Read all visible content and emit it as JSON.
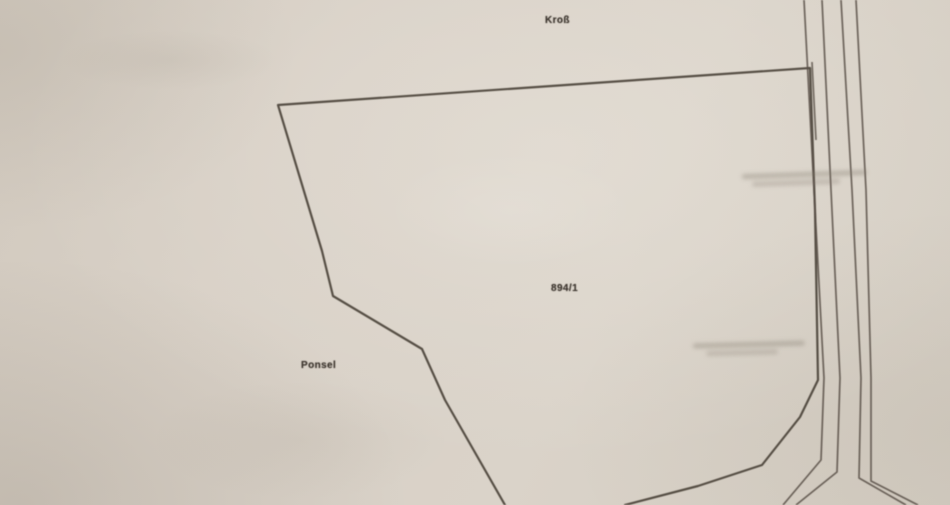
{
  "labels": {
    "top": "Kroß",
    "parcel_number": "894/1",
    "left": "Ponsel"
  },
  "colors": {
    "paper": "#d7cfc5",
    "parcel_line": "#4b433a",
    "road_line": "#584f46",
    "label_ink": "#3c352e"
  },
  "geometry": {
    "parcel_boundary": "505,505 445,400 422,349 333,296 322,251 278,105 810,68 815,210 818,380 800,417 762,465 698,486 625,505",
    "road_line_1": "804,0 814,190 824,378 821,460 783,505",
    "road_line_2": "822,0 831,190 840,378 837,472 796,505",
    "road_line_3": "841,0 852,190 861,378 859,478 906,505",
    "road_line_4": "856,0 866,190 871,378 871,481 918,505",
    "road_stub": "812,62 816,140"
  }
}
